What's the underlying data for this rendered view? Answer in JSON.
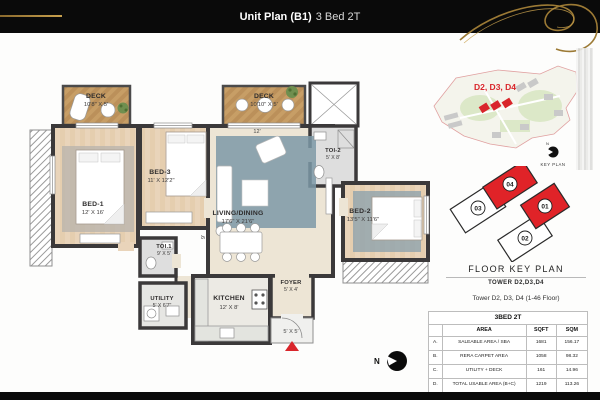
{
  "header": {
    "title": "Unit Plan (B1)",
    "subtitle": "3 Bed 2T"
  },
  "plan": {
    "rooms": {
      "deck1": {
        "name": "DECK",
        "dim": "10'8\" X 5'"
      },
      "bed1": {
        "name": "BED-1",
        "dim": "12' X 16'"
      },
      "bed3": {
        "name": "BED-3",
        "dim": "11' X 12'2\""
      },
      "deck2": {
        "name": "DECK",
        "dim": "10'10\" X 5'"
      },
      "toi2": {
        "name": "TOI-2",
        "dim": "5' X 8'"
      },
      "living": {
        "name": "LIVING/DINING",
        "dim": "17'6\" X 21'6\""
      },
      "bed2": {
        "name": "BED-2",
        "dim": "13'5\" X 11'6\""
      },
      "toi1": {
        "name": "TOI.1",
        "dim": "9' X 5'"
      },
      "utility": {
        "name": "UTILITY",
        "dim": "5' X 6'7\""
      },
      "kitchen": {
        "name": "KITCHEN",
        "dim": "12' X 8'"
      },
      "foyer": {
        "name": "FOYER",
        "dim": "5' X 4'"
      }
    },
    "dimensions": {
      "entry": "5' X 5'",
      "deck2_width": "12'",
      "living_depth": "9'"
    },
    "north": "N"
  },
  "sitemap": {
    "label": "D2, D3, D4",
    "caption": "KEY PLAN"
  },
  "floor_key": {
    "title": "FLOOR KEY PLAN",
    "tower": "TOWER D2,D3,D4",
    "note": "Tower D2, D3, D4 (1-46 Floor)",
    "units": {
      "u01": "01",
      "u02": "02",
      "u03": "03",
      "u04": "04"
    }
  },
  "table": {
    "title": "3BED 2T",
    "columns": [
      "",
      "AREA",
      "SQFT",
      "SQM"
    ],
    "rows": [
      [
        "A.",
        "SALEABLE AREA / SBA",
        "1681",
        "156.17"
      ],
      [
        "B.",
        "RERA CARPET AREA",
        "1058",
        "98.32"
      ],
      [
        "C.",
        "UTILITY + DECK",
        "161",
        "14.96"
      ],
      [
        "D.",
        "TOTAL USABLE AREA (B+C)",
        "1219",
        "113.26"
      ]
    ]
  },
  "colors": {
    "accent_red": "#d9252b",
    "gold": "#a07a33",
    "wall": "#3b393a"
  }
}
